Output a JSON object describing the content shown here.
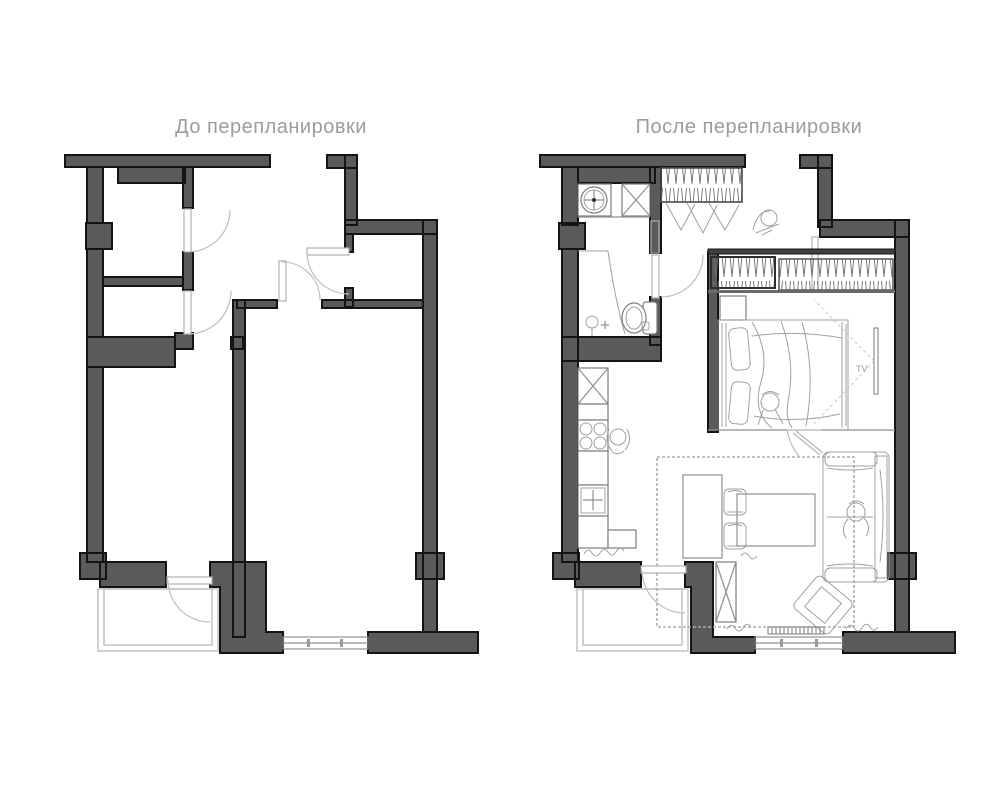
{
  "page": {
    "kind": "apartment floor plan comparison, before and after renovation",
    "background_color": "#ffffff"
  },
  "colors": {
    "wall_fill": "#595a5c",
    "wall_stroke": "#141414",
    "door_line": "#c2c2c2",
    "fixture_line": "#7d7d7d",
    "sketch_line": "#a0a0a0",
    "title_text": "#9c9c9c"
  },
  "plans": {
    "before": {
      "title": "До перепланировки",
      "elements": [
        "outer-walls",
        "two-small-rooms-with-doors",
        "entry-hall",
        "small-room-top-right",
        "large-room-left",
        "large-room-right",
        "balcony-with-door",
        "window-bottom",
        "wall-pillars"
      ]
    },
    "after": {
      "title": "После перепланировки",
      "tv_label": "TV",
      "elements": [
        "bathroom-with-washer-and-toilet",
        "hall-wardrobe-with-clothes",
        "entry-door",
        "kitchen-run-with-stove-and-sink",
        "kitchen-island-with-stools",
        "bedroom-with-bed",
        "bedroom-wardrobes",
        "tv-on-wall",
        "living-room-sofa",
        "coffee-table",
        "rug",
        "armchair",
        "shelving-unit",
        "balcony-with-door",
        "window-with-radiator",
        "people-sketches",
        "wall-pillars"
      ]
    }
  }
}
